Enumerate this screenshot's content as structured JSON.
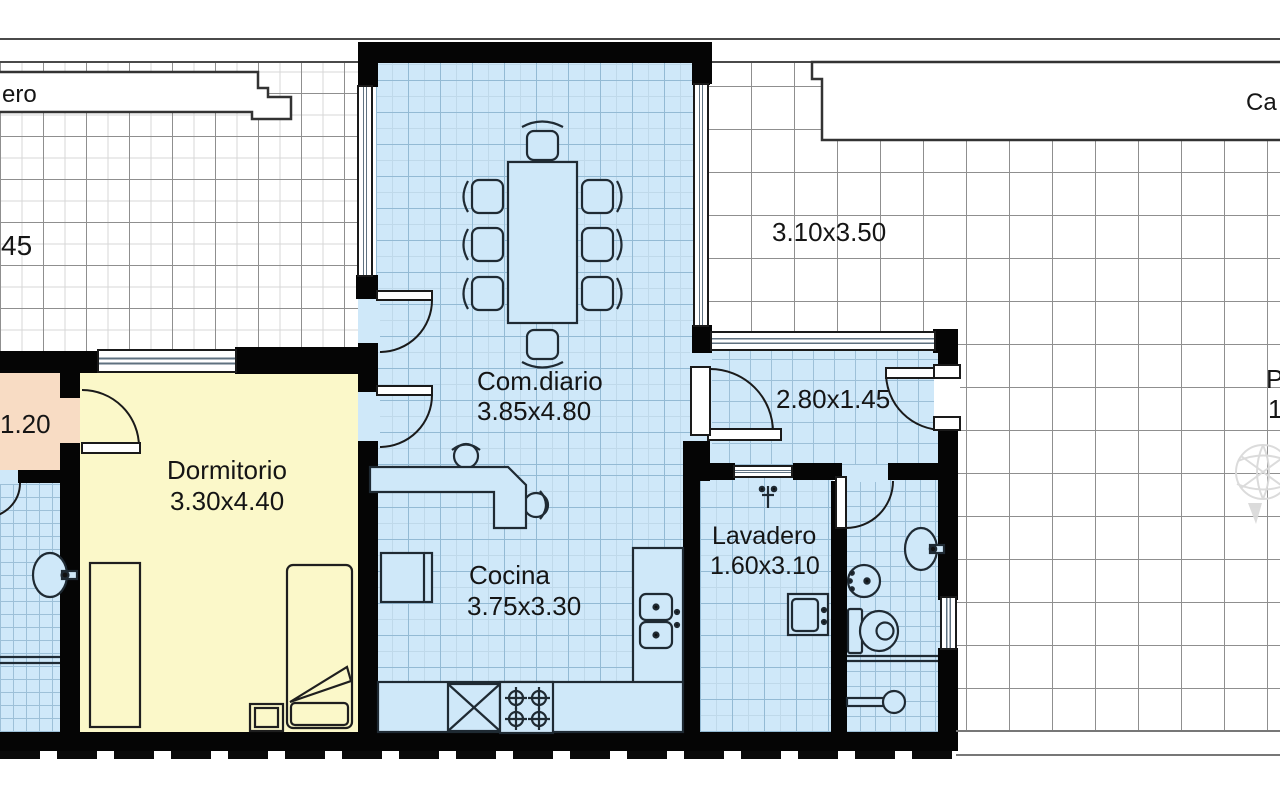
{
  "rooms": {
    "comDiario": {
      "name": "Com.diario",
      "dims": "3.85x4.80"
    },
    "dormitorio": {
      "name": "Dormitorio",
      "dims": "3.30x4.40"
    },
    "cocina": {
      "name": "Cocina",
      "dims": "3.75x3.30"
    },
    "lavadero": {
      "name": "Lavadero",
      "dims": "1.60x3.10"
    },
    "hall": {
      "dims": "2.80x1.45"
    },
    "patio": {
      "dims": "3.10x3.50"
    },
    "pasillo": {
      "dims": "1.20"
    }
  },
  "partialLabels": {
    "topLeft": "ero",
    "topRight": "Ca",
    "leftDim": "45",
    "rightP": "P",
    "rightNum": "1"
  },
  "colors": {
    "wall": "#050505",
    "floorBlue": "#cfe8f9",
    "floorYellow": "#fbf8c9",
    "floorPeach": "#f8dcc4",
    "patioGrid": "#8f8f8f",
    "blueGrid": "#93bad4"
  }
}
